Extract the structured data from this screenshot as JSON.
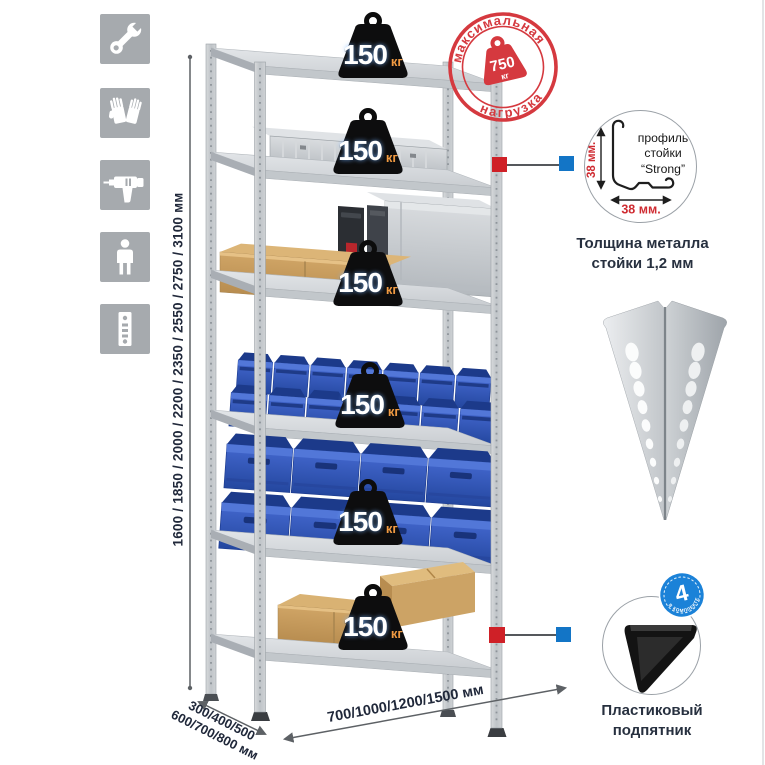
{
  "icons": {
    "items": [
      {
        "icon": "wrench-icon"
      },
      {
        "icon": "gloves-icon"
      },
      {
        "icon": "drill-icon"
      },
      {
        "icon": "person-icon"
      },
      {
        "icon": "perforated-profile-icon"
      }
    ]
  },
  "dimensions": {
    "height_label": "1600 / 1850 / 2000 / 2200 / 2350 / 2550 / 2750 / 3100 мм",
    "depth_label_line1": "300/400/500",
    "depth_label_line2": "600/700/800 мм",
    "width_label": "700/1000/1200/1500 мм"
  },
  "stamp": {
    "arc_top": "максимальная",
    "arc_bottom": "нагрузка",
    "weight_value": "750",
    "weight_unit": "кг"
  },
  "shelf_badges": [
    {
      "value": "150",
      "unit": "кг"
    },
    {
      "value": "150",
      "unit": "кг"
    },
    {
      "value": "150",
      "unit": "кг"
    },
    {
      "value": "150",
      "unit": "кг"
    },
    {
      "value": "150",
      "unit": "кг"
    },
    {
      "value": "150",
      "unit": "кг"
    }
  ],
  "profile_detail": {
    "label_line1": "профиль",
    "label_line2": "стойки",
    "label_line3": "“Strong”",
    "dim_vertical": "38 мм.",
    "dim_horizontal": "38 мм.",
    "caption_line1": "Толщина металла",
    "caption_line2": "стойки 1,2 мм"
  },
  "foot_detail": {
    "badge_value": "4",
    "badge_arc_text": "в комплекте",
    "caption_line1": "Пластиковый",
    "caption_line2": "подпятник"
  },
  "colors": {
    "accent_red": "#cf2027",
    "accent_blue": "#1375c6",
    "stamp_red": "#d5393f",
    "bin_blue": "#2e55b8",
    "metal_gray": "#c7cbcf",
    "icon_gray": "#a6aaae"
  }
}
